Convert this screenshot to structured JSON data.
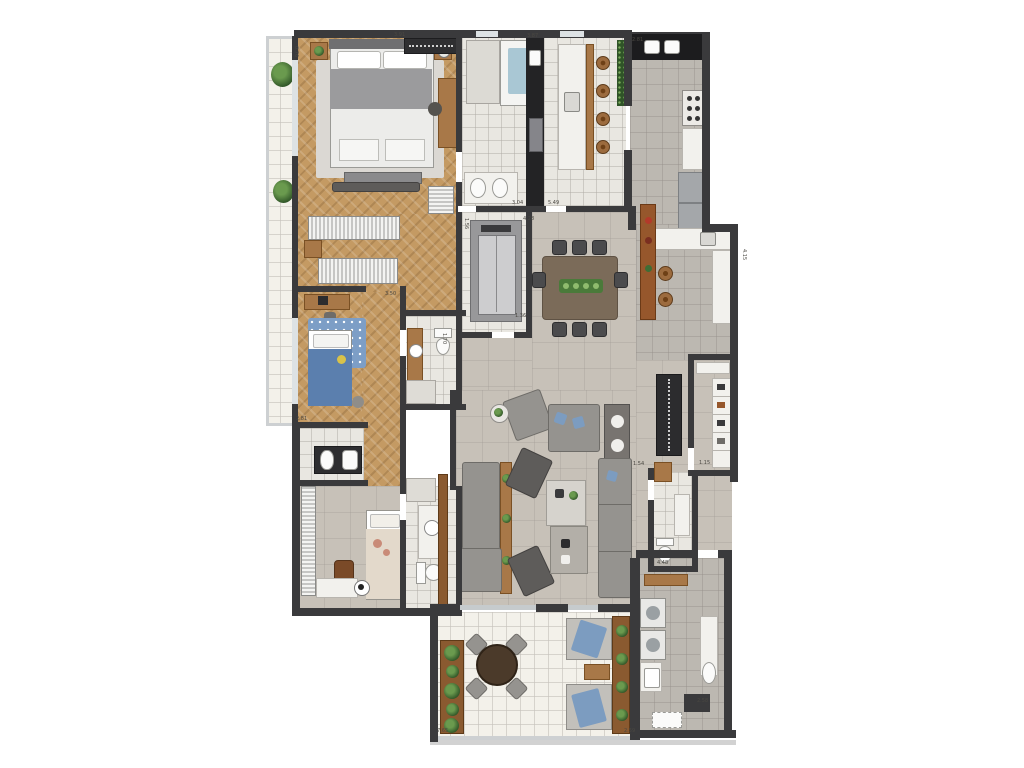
{
  "palette": {
    "wall": "#3a3a3c",
    "wood_floor": "#c49a63",
    "tile_light": "#e9e7e1",
    "tile_gray": "#bcb8b1",
    "floor_warm": "#c7c1b8",
    "floor_terrace": "#f3f1ea",
    "floor_plain": "#d8d5cf",
    "furniture_wood": "#a87848",
    "furniture_wood_dark": "#8a5a30",
    "counter_white": "#f2f1ed",
    "counter_black": "#1c1c1e",
    "appliance_steel": "#a4a7aa",
    "sofa_gray": "#95938f",
    "sofa_dark": "#5e5c5a",
    "bed_linen": "#ececea",
    "kids_blue": "#5b7fae",
    "rug_blue": "#7d9ec6",
    "accent_blue": "#7c9cc0",
    "plant_green": "#2f5427",
    "glass": "#dde2e4",
    "slab_gray": "#d2d2d2",
    "label_color": "#4a4842"
  },
  "dimension_labels": [
    {
      "text": "0.76",
      "x": 293,
      "y": 46,
      "vertical": true
    },
    {
      "text": "3.91",
      "x": 394,
      "y": 32,
      "vertical": false
    },
    {
      "text": "3.87",
      "x": 527,
      "y": 33,
      "vertical": false
    },
    {
      "text": "2.81",
      "x": 632,
      "y": 37,
      "vertical": false
    },
    {
      "text": "3.04",
      "x": 512,
      "y": 200,
      "vertical": false
    },
    {
      "text": "5.49",
      "x": 548,
      "y": 200,
      "vertical": false
    },
    {
      "text": "4.28",
      "x": 523,
      "y": 216,
      "vertical": false
    },
    {
      "text": "1.56",
      "x": 463,
      "y": 218,
      "vertical": true
    },
    {
      "text": "3.50",
      "x": 385,
      "y": 291,
      "vertical": false
    },
    {
      "text": "1.70",
      "x": 441,
      "y": 333,
      "vertical": true
    },
    {
      "text": "1.36",
      "x": 515,
      "y": 313,
      "vertical": false
    },
    {
      "text": "2.81",
      "x": 296,
      "y": 416,
      "vertical": false
    },
    {
      "text": "4.15",
      "x": 741,
      "y": 249,
      "vertical": true
    },
    {
      "text": "1.54",
      "x": 633,
      "y": 461,
      "vertical": false
    },
    {
      "text": "1.15",
      "x": 699,
      "y": 460,
      "vertical": false
    },
    {
      "text": "4.48",
      "x": 657,
      "y": 560,
      "vertical": false
    },
    {
      "text": "7.65",
      "x": 437,
      "y": 728,
      "vertical": false
    },
    {
      "text": "2.59",
      "x": 624,
      "y": 728,
      "vertical": false
    },
    {
      "text": "2.58",
      "x": 697,
      "y": 698,
      "vertical": false
    }
  ]
}
